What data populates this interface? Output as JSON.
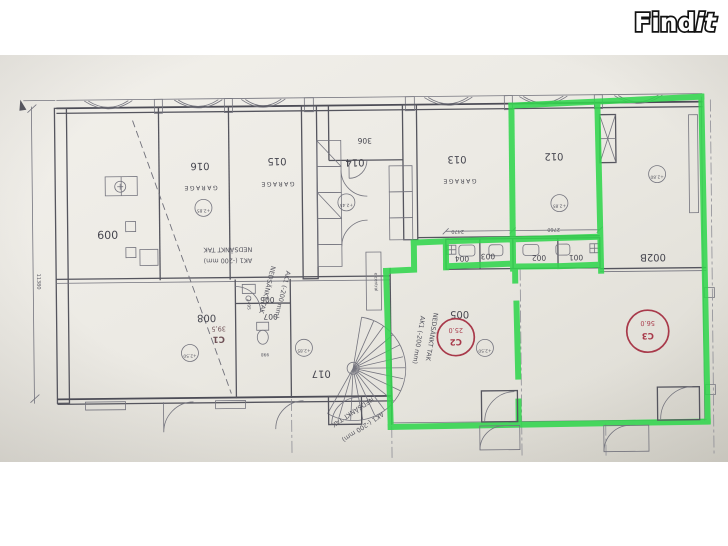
{
  "page": {
    "background": "#ffffff"
  },
  "logo": {
    "part_bold": "Find",
    "part_italic": "it"
  },
  "colors": {
    "highlight_green": "#32d64e",
    "badge_red": "#a8394a",
    "paper": "#eceae4",
    "ink": "#45454e"
  },
  "plan": {
    "room_labels": [
      "009",
      "016",
      "015",
      "014",
      "013",
      "012",
      "002B",
      "306",
      "004",
      "003",
      "002",
      "001",
      "005",
      "006",
      "007",
      "008",
      "017"
    ],
    "garage_label": "GARAGE",
    "area_badges": [
      {
        "code": "C1",
        "area": "39,5"
      },
      {
        "code": "C2",
        "area": "25.0"
      },
      {
        "code": "C3",
        "area": "56.0"
      }
    ],
    "elevation_markers": [
      "+2.85",
      "+2.45",
      "+2.85",
      "+2.80",
      "+2.50",
      "+2.50",
      "+2.85"
    ],
    "dimensions": {
      "cells_left": "2470",
      "cells_right": "2760",
      "building_height": "11380",
      "room_depth": "2495",
      "door_width": "998"
    },
    "ceiling_note": {
      "line1": "NEDSÄNKT TAK",
      "line2": "AK1 (-200 mm)"
    },
    "elcentral_label": "elcentral"
  }
}
